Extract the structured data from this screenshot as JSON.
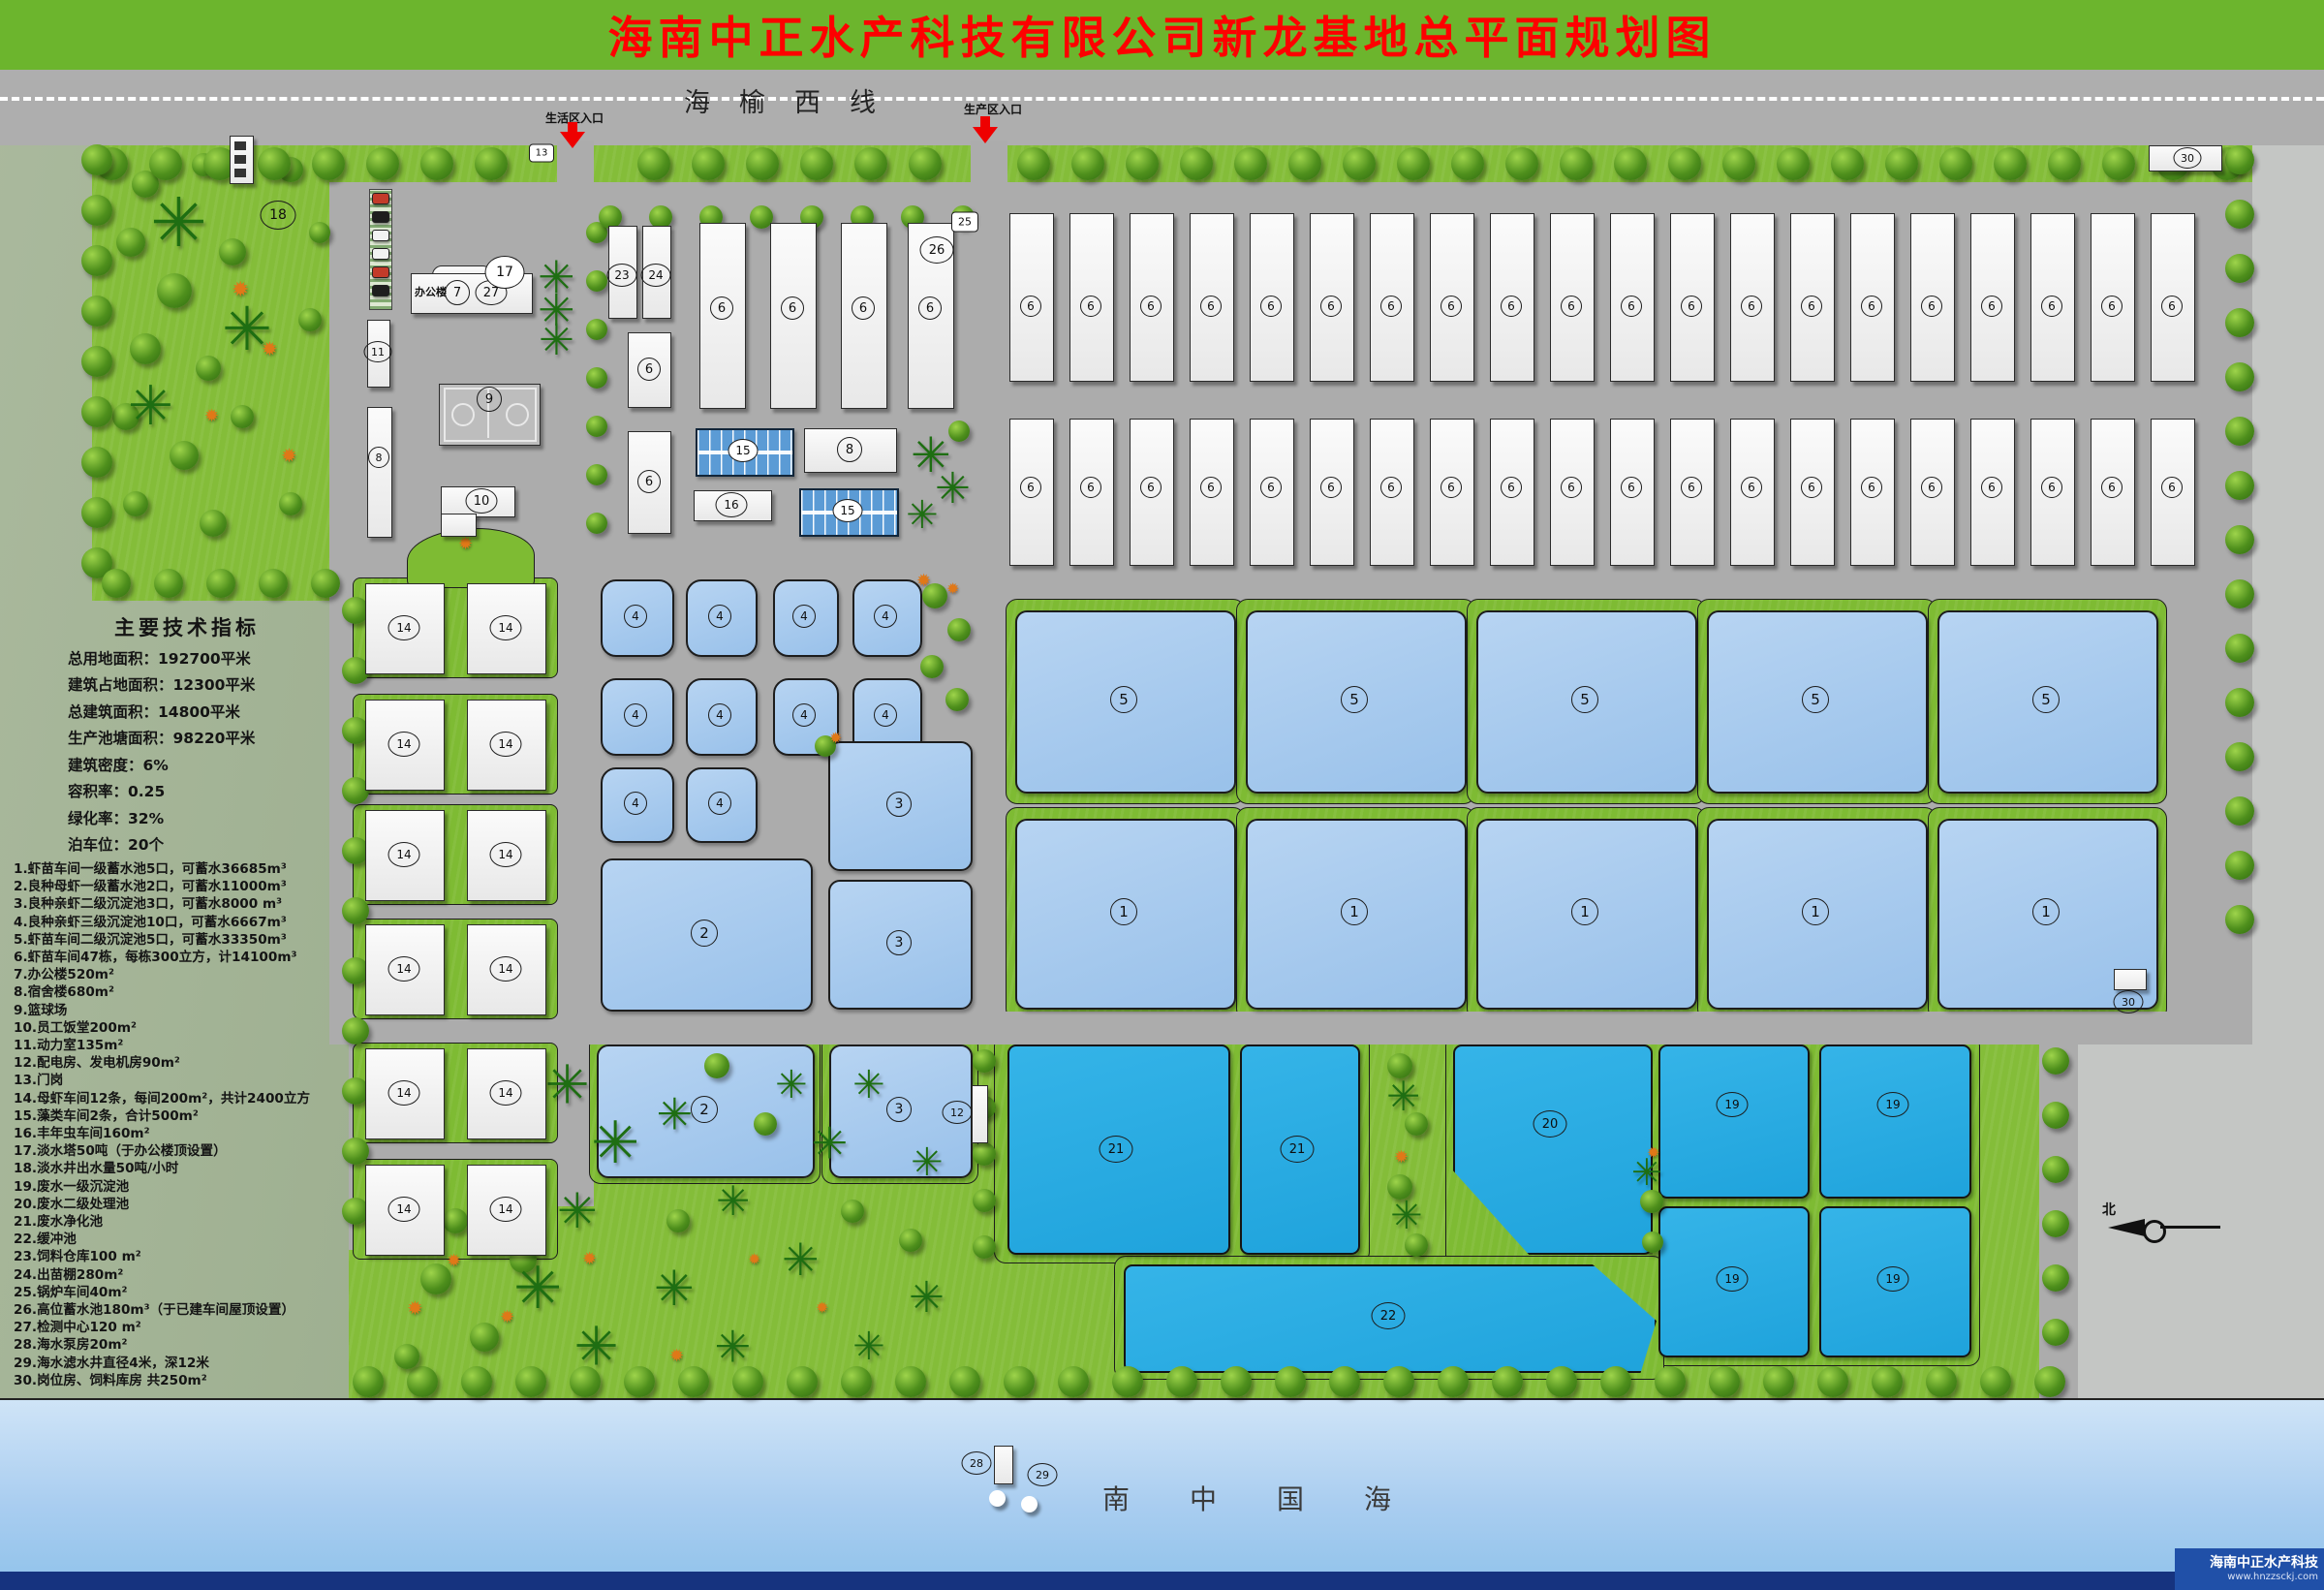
{
  "title": "海南中正水产科技有限公司新龙基地总平面规划图",
  "road": {
    "name": "海榆西线",
    "entrance_life": "生活区入口",
    "entrance_prod": "生产区入口"
  },
  "indicators": {
    "heading": "主要技术指标",
    "lines": [
      "总用地面积：192700平米",
      "建筑占地面积：12300平米",
      "总建筑面积：14800平米",
      "生产池塘面积：98220平米",
      "建筑密度：6%",
      "容积率：0.25",
      "绿化率：32%",
      "泊车位：20个"
    ]
  },
  "legend": [
    "1.虾苗车间一级蓄水池5口，可蓄水36685m³",
    "2.良种母虾一级蓄水池2口，可蓄水11000m³",
    "3.良种亲虾二级沉淀池3口，可蓄水8000 m³",
    "4.良种亲虾三级沉淀池10口，可蓄水6667m³",
    "5.虾苗车间二级沉淀池5口，可蓄水33350m³",
    "6.虾苗车间47栋，每栋300立方，计14100m³",
    "7.办公楼520m²",
    "8.宿舍楼680m²",
    "9.篮球场",
    "10.员工饭堂200m²",
    "11.动力室135m²",
    "12.配电房、发电机房90m²",
    "13.门岗",
    "14.母虾车间12条，每间200m²，共计2400立方",
    "15.藻类车间2条，合计500m²",
    "16.丰年虫车间160m²",
    "17.淡水塔50吨（于办公楼顶设置）",
    "18.淡水井出水量50吨/小时",
    "19.废水一级沉淀池",
    "20.废水二级处理池",
    "21.废水净化池",
    "22.缓冲池",
    "23.饲料仓库100 m²",
    "24.出苗棚280m²",
    "25.锅炉车间40m²",
    "26.高位蓄水池180m³（于已建车间屋顶设置）",
    "27.检测中心120 m²",
    "28.海水泵房20m²",
    "29.海水滤水井直径4米，深12米",
    "30.岗位房、饲料库房 共250m²"
  ],
  "office": {
    "label": "办公楼"
  },
  "sea": {
    "name": "南中国海"
  },
  "compass": {
    "north": "北"
  },
  "logo": {
    "company": "海南中正水产科技",
    "url": "www.hnzzsckj.com"
  }
}
